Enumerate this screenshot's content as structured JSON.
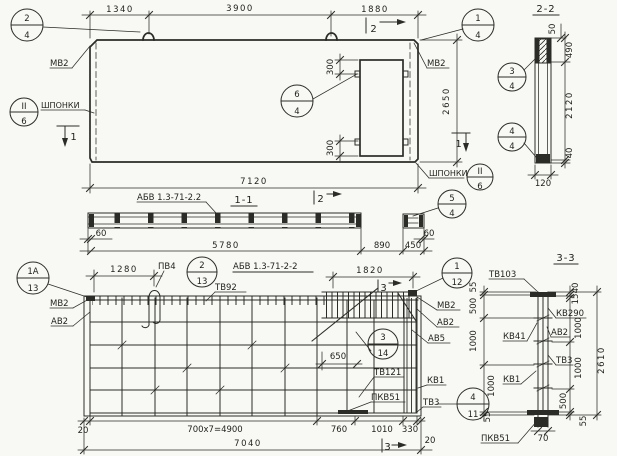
{
  "colors": {
    "ink": "#2b2b27",
    "paper": "#f8f8f4"
  },
  "elevation": {
    "dims": {
      "a": "1340",
      "b": "3900",
      "c": "1880",
      "door_top": "300",
      "door_bot": "300",
      "height": "2650",
      "total": "7120"
    },
    "labels": {
      "mv2_left": "МВ2",
      "mv2_right": "МВ2",
      "shp_left": "ШПОНКИ",
      "shp_right": "ШПОНКИ"
    },
    "cuts": {
      "top": "2",
      "left": "1",
      "right": "1"
    },
    "markers": {
      "m24": {
        "top": "2",
        "bot": "4"
      },
      "m14": {
        "top": "1",
        "bot": "4"
      },
      "m64": {
        "top": "6",
        "bot": "4"
      },
      "shp_l": {
        "top": "II",
        "bot": "6"
      },
      "shp_r": {
        "top": "II",
        "bot": "6"
      }
    }
  },
  "section22": {
    "title": "2-2",
    "dims": {
      "top50": "50",
      "h490": "490",
      "h2120": "2120",
      "h40": "40",
      "w120": "120"
    },
    "markers": {
      "m34": {
        "top": "3",
        "bot": "4"
      },
      "m44": {
        "top": "4",
        "bot": "4"
      }
    }
  },
  "section11": {
    "label": "АБВ 1.3-71-2.2",
    "title": "1-1",
    "cut": "2",
    "marker": {
      "top": "5",
      "bot": "4"
    },
    "dims": {
      "l60": "60",
      "main": "5780",
      "gap": "890",
      "piece": "450",
      "r60": "60"
    }
  },
  "rebar": {
    "title": "АБВ 1.3-71-2-2",
    "labels": {
      "pv4": "ПВ4",
      "tv92": "ТВ92",
      "mv2_l": "МВ2",
      "av2_l": "АВ2",
      "mv2_r": "МВ2",
      "av2_r": "АВ2",
      "av5": "АВ5",
      "tv121": "ТВ121",
      "kv1": "КВ1",
      "pkv51": "ПКВ51",
      "tv3": "ТВ3"
    },
    "cuts": {
      "top": "3",
      "bottom": "3"
    },
    "markers": {
      "m1a13": {
        "top": "1А",
        "bot": "13"
      },
      "m213": {
        "top": "2",
        "bot": "13"
      },
      "m112": {
        "top": "1",
        "bot": "12"
      },
      "m314": {
        "top": "3",
        "bot": "14"
      },
      "m411": {
        "top": "4",
        "bot": "11"
      }
    },
    "dims": {
      "d1280": "1280",
      "d1820": "1820",
      "d650": "650",
      "l20": "20",
      "run": "700x7=4900",
      "d760": "760",
      "d1010": "1010",
      "d330": "330",
      "r20": "20",
      "total": "7040"
    }
  },
  "section33": {
    "title": "3-3",
    "labels": {
      "tv103": "ТВ103",
      "kv290": "КВ290",
      "av2": "АВ2",
      "kv41": "КВ41",
      "tv3": "ТВ3",
      "kv1": "КВ1",
      "pkv51": "ПКВ51"
    },
    "left": {
      "s55a": "55",
      "s500": "500",
      "s1000a": "1000",
      "s1000b": "1000",
      "s55b": "55"
    },
    "right": {
      "s40": "40",
      "s15": "15",
      "s1000a": "1000",
      "s1000b": "1000",
      "s500": "500",
      "s55": "55",
      "total": "2610"
    },
    "bottom": {
      "d70": "70"
    }
  }
}
